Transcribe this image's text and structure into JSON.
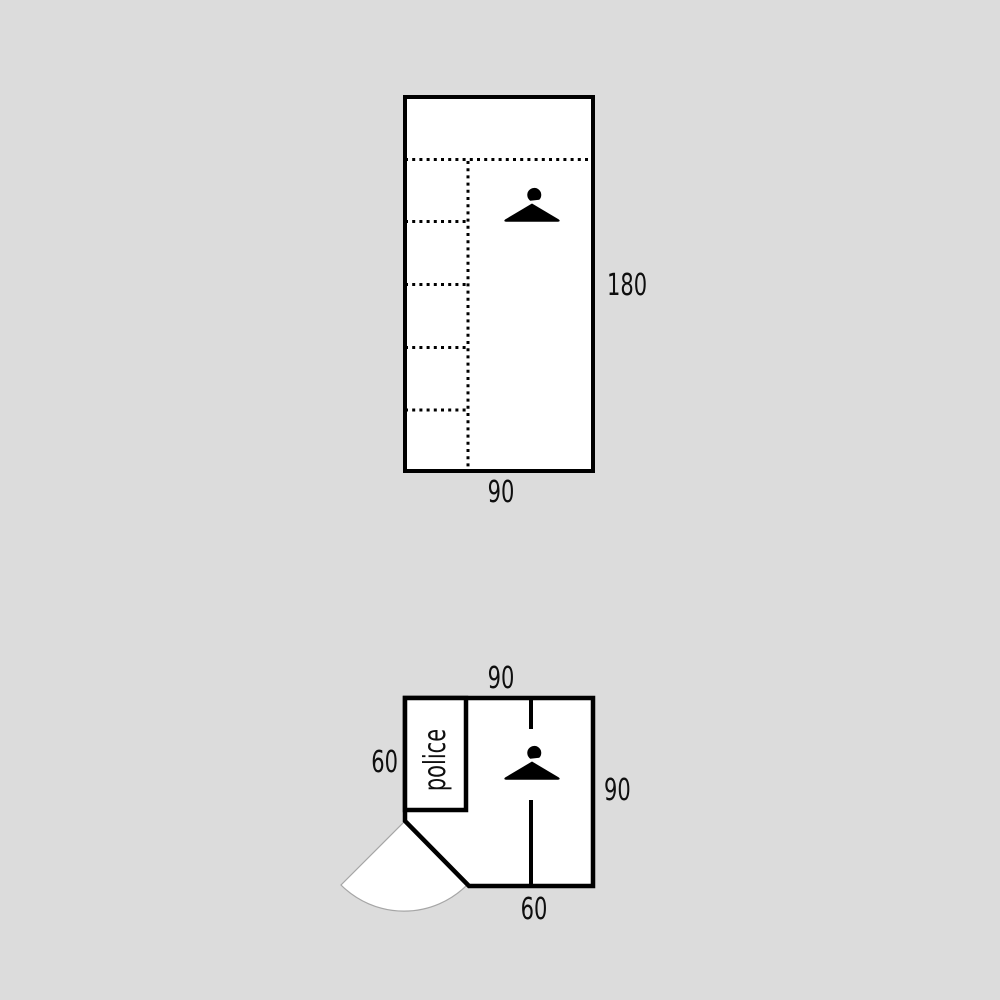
{
  "page": {
    "background_color": "#dcdcdc",
    "shape_fill_color": "#ffffff",
    "line_color": "#000000",
    "door_arc_color": "#a6a6a6",
    "text_color": "#0f0f0f"
  },
  "front_view": {
    "height_label": "180",
    "width_label": "90",
    "hanger_icon": "hanger-icon"
  },
  "plan_view": {
    "top_width_label": "90",
    "left_depth_label": "60",
    "right_depth_label": "90",
    "bottom_width_label": "60",
    "compartment_text": "police",
    "hanger_icon": "hanger-icon",
    "door_icon": "door-swing-icon"
  }
}
